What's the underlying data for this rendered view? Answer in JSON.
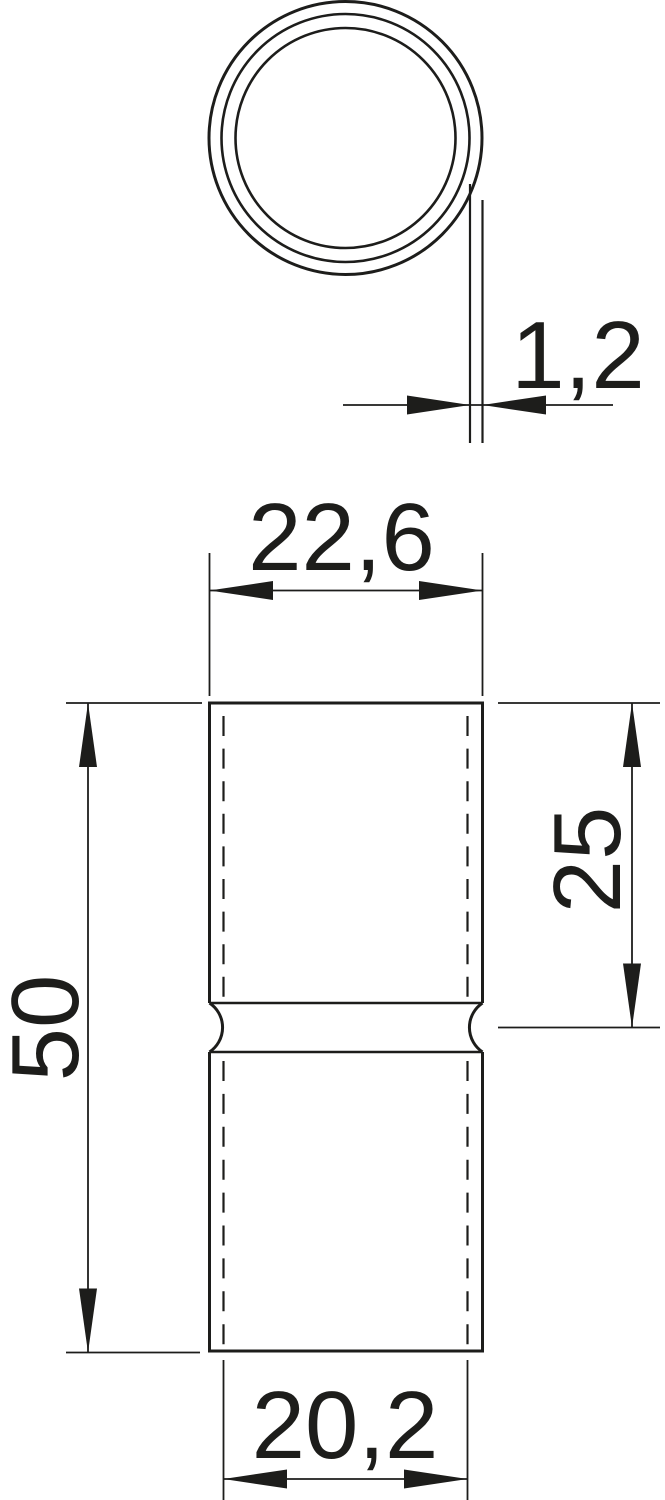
{
  "drawing": {
    "kind": "technical-drawing-2-views",
    "colors": {
      "line": "#1d1d1b",
      "background": "#ffffff"
    },
    "dimensions": {
      "wall_thickness": {
        "label": "1,2"
      },
      "outer_width": {
        "label": "22,6"
      },
      "overall_length": {
        "label": "50"
      },
      "upper_section_length": {
        "label": "25"
      },
      "inner_width": {
        "label": "20,2"
      }
    }
  }
}
